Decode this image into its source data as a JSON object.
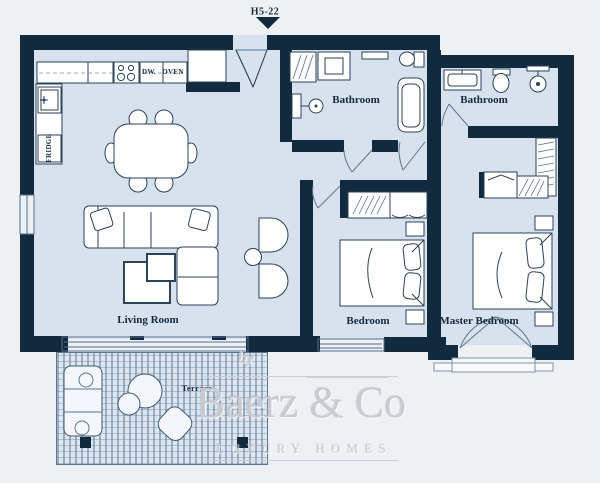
{
  "plan": {
    "unit_label": "H5-22",
    "rooms": {
      "living_room": "Living Room",
      "bedroom": "Bedroom",
      "master_bedroom": "Master Bedroom",
      "bathroom_1": "Bathroom",
      "bathroom_2": "Bathroom",
      "terrace": "Terrace"
    },
    "appliances": {
      "dishwasher": "DW.",
      "oven": "OVEN",
      "fridge": "FRIDGE"
    }
  },
  "watermark": {
    "prefix": "by",
    "brand": "Baerz & Co",
    "tagline": "LUXURY HOMES"
  },
  "colors": {
    "wall": "#122a3d",
    "floor": "#d8e2ee",
    "terrace_floor": "#dce5f0",
    "background": "#eef1f4",
    "fixture_line": "#2b4257",
    "watermark": "#c7cbd1"
  }
}
